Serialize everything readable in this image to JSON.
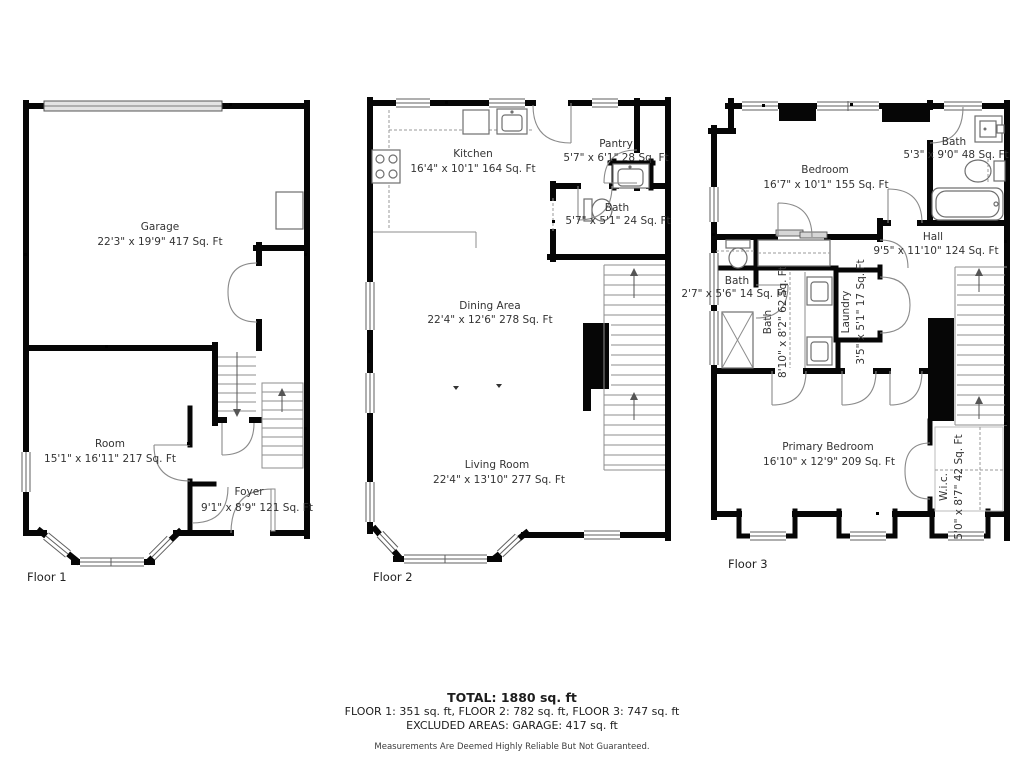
{
  "title": "Three floor residential floor plan",
  "colors": {
    "wall": "#060606",
    "label_text": "#333333",
    "window_frame": "#5f5f5f",
    "door_arc": "#8a8a8a",
    "garage_door_fill": "#e3e3e3"
  },
  "floors": [
    {
      "label": "Floor 1",
      "rooms": [
        {
          "name": "Garage",
          "dims": "22'3\" x 19'9\" 417 Sq. Ft"
        },
        {
          "name": "Room",
          "dims": "15'1\" x 16'11\" 217 Sq. Ft"
        },
        {
          "name": "Foyer",
          "dims": "9'1\" x 8'9\" 121 Sq. Ft"
        }
      ]
    },
    {
      "label": "Floor 2",
      "rooms": [
        {
          "name": "Kitchen",
          "dims": "16'4\" x 10'1\" 164 Sq. Ft"
        },
        {
          "name": "Pantry",
          "dims": "5'7\" x 6'1\" 28 Sq. Ft"
        },
        {
          "name": "Bath",
          "dims": "5'7\" x 5'1\" 24 Sq. Ft"
        },
        {
          "name": "Dining Area",
          "dims": "22'4\" x 12'6\" 278 Sq. Ft"
        },
        {
          "name": "Living Room",
          "dims": "22'4\" x 13'10\" 277 Sq. Ft"
        }
      ]
    },
    {
      "label": "Floor 3",
      "rooms": [
        {
          "name": "Bedroom",
          "dims": "16'7\" x 10'1\" 155 Sq. Ft"
        },
        {
          "name": "Bath",
          "dims": "5'3\" x 9'0\" 48 Sq. Ft"
        },
        {
          "name": "Hall",
          "dims": "9'5\" x 11'10\" 124 Sq. Ft"
        },
        {
          "name": "Bath",
          "dims": "2'7\" x 5'6\" 14 Sq. Ft"
        },
        {
          "name": "Bath",
          "dims": "8'10\" x 8'2\" 62 Sq. Ft"
        },
        {
          "name": "Laundry",
          "dims": "3'5\" x 5'1\" 17 Sq. Ft"
        },
        {
          "name": "Primary Bedroom",
          "dims": "16'10\" x 12'9\" 209 Sq. Ft"
        },
        {
          "name": "W.i.c.",
          "dims": "5'0\" x 8'7\" 42 Sq. Ft"
        }
      ]
    }
  ],
  "summary": {
    "total": "TOTAL: 1880 sq. ft",
    "floors_line": "FLOOR 1: 351 sq. ft, FLOOR 2: 782 sq. ft, FLOOR 3: 747 sq. ft",
    "excluded": "EXCLUDED AREAS: GARAGE: 417 sq. ft",
    "disclaimer": "Measurements Are Deemed Highly Reliable But Not Guaranteed."
  }
}
